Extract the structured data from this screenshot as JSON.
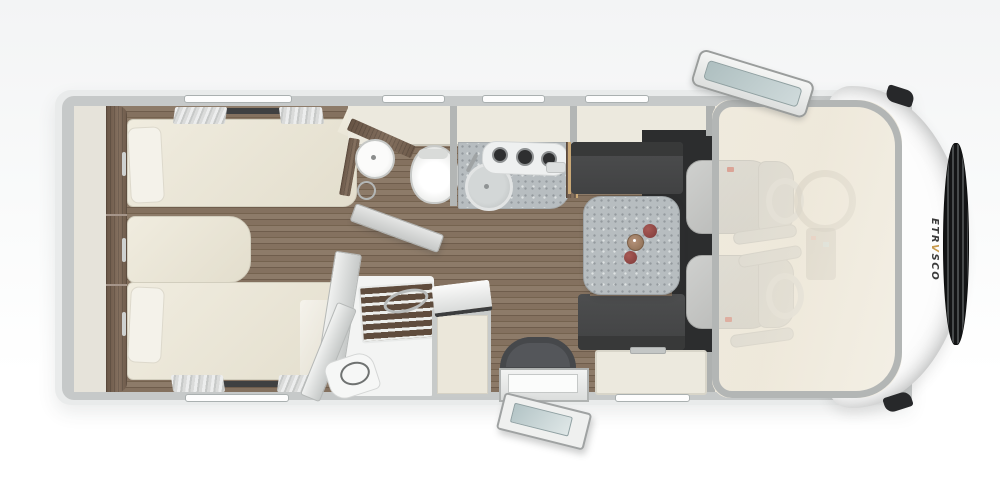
{
  "meta": {
    "title": "Etrusco motorhome floor plan, top view"
  },
  "brand": {
    "pre": "ETR",
    "accent": "V",
    "post": "SCO",
    "accent_color": "#c79a4d",
    "text_color": "#3b3b3b"
  },
  "palette": {
    "body_white": "#fdfdfd",
    "wall_gray": "#c6c9c9",
    "floor_wood": "#83705e",
    "furniture_cream": "#ece9de",
    "bench_charcoal": "#454647",
    "terrazzo_gray": "#b7bdc0",
    "dark_wood": "#74604f",
    "glass_teal": "#aebfc0",
    "seatbelt_red": "#c0483c",
    "grille_black": "#1e1f20"
  },
  "floorplan": {
    "areas": [
      {
        "name": "rear-twin-bedroom",
        "items": [
          "wardrobe-headboard",
          "twin-bed-top",
          "twin-bed-bottom",
          "bed-extension-cushion",
          "pillows",
          "windows-with-curtains"
        ]
      },
      {
        "name": "bathroom",
        "items": [
          "corner-vanity",
          "round-washbasin",
          "toilet",
          "towel-ring",
          "open-bathroom-door"
        ]
      },
      {
        "name": "shower-room",
        "items": [
          "teak-slat-grate",
          "folding-glass-doors",
          "shower-hose",
          "cabinet-with-open-lid"
        ]
      },
      {
        "name": "kitchen",
        "items": [
          "terrazzo-counter",
          "round-sink",
          "three-burner-hob",
          "tall-cabinet"
        ]
      },
      {
        "name": "dinette",
        "items": [
          "terrazzo-table",
          "front-bench",
          "rear-bench",
          "sideboard",
          "serving-tray-with-fruit"
        ]
      },
      {
        "name": "entrance",
        "items": [
          "half-round-entry-mat",
          "entry-step",
          "open-entry-door"
        ]
      },
      {
        "name": "cab",
        "items": [
          "driver-swivel-seat",
          "passenger-swivel-seat",
          "steering-wheel",
          "dashboard-console",
          "open-skyroof-hatch",
          "side-mirrors",
          "front-grille"
        ]
      }
    ]
  }
}
